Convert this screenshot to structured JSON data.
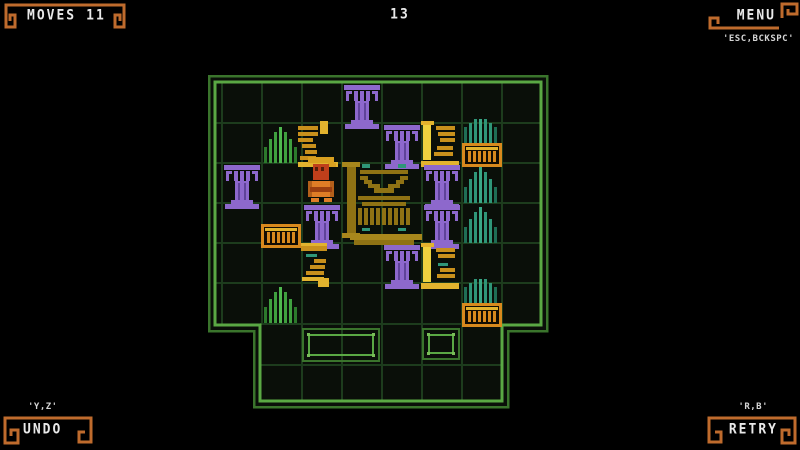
{
  "hud": {
    "moves_label": "MOVES",
    "moves_value": "11",
    "level_number": "13",
    "menu_label": "MENU",
    "menu_hint": "'ESC,BCKSPC'",
    "undo_label": "UNDO",
    "undo_hint": "'Y,Z'",
    "retry_label": "RETRY",
    "retry_hint": "'R,B'"
  },
  "palette": {
    "background": "#000000",
    "board_fill": "#0a0f09",
    "grid_line": "#1d3c1d",
    "border_outer": "#3a742c",
    "border_inner": "#5aa844",
    "goal_dot": "#79bd58",
    "hud_orange": "#bf6b2d",
    "text_white": "#e9e9e9",
    "purple": "#8d68cc",
    "purple_dark": "#5f4399",
    "gold": "#c8901c",
    "gold_bright": "#e2b32e",
    "yellow": "#edd23f",
    "teal": "#2f9678",
    "teal_dark": "#1f6e55",
    "teal_bright": "#3aa886",
    "green": "#3fa03f",
    "green_dark": "#2c7a2c",
    "green_bright": "#4fb84f",
    "crate": "#d8891d",
    "crate_dark": "#7a4c0e",
    "ink": "#120c02",
    "statue": "#8f7214",
    "statue_bright": "#a8871c",
    "player_body": "#df7d26",
    "player_arm": "#b35f1a",
    "player_belt": "#9c3f10",
    "player_head": "#bf3f1b",
    "player_eye": "#551d0a",
    "player_hat": "#d8a020"
  },
  "board": {
    "cols": 8,
    "rows": 6,
    "cell_px": 40,
    "origin_x": 222,
    "origin_y": 83,
    "objects": [
      {
        "type": "pillar-purple",
        "col": 3,
        "row": 0
      },
      {
        "type": "plant-green",
        "col": 1,
        "row": 1
      },
      {
        "type": "broken-column-left",
        "col": 2,
        "row": 1
      },
      {
        "type": "pillar-purple",
        "col": 4,
        "row": 1
      },
      {
        "type": "broken-column-right",
        "col": 5,
        "row": 1
      },
      {
        "type": "crate-plant",
        "col": 6,
        "row": 1
      },
      {
        "type": "pillar-purple",
        "col": 0,
        "row": 2
      },
      {
        "type": "player",
        "col": 2,
        "row": 2
      },
      {
        "type": "statue",
        "col": 3,
        "row": 2,
        "span_cols": 2,
        "span_rows": 2
      },
      {
        "type": "pillar-purple",
        "col": 5,
        "row": 2
      },
      {
        "type": "plant-teal",
        "col": 6,
        "row": 2
      },
      {
        "type": "crate",
        "col": 1,
        "row": 3
      },
      {
        "type": "pillar-purple",
        "col": 2,
        "row": 3
      },
      {
        "type": "pillar-purple",
        "col": 5,
        "row": 3
      },
      {
        "type": "plant-teal",
        "col": 6,
        "row": 3
      },
      {
        "type": "stairs-down",
        "col": 2,
        "row": 4
      },
      {
        "type": "pillar-purple",
        "col": 4,
        "row": 4
      },
      {
        "type": "broken-column-right-teal",
        "col": 5,
        "row": 4
      },
      {
        "type": "plant-green",
        "col": 1,
        "row": 5
      },
      {
        "type": "crate-plant",
        "col": 6,
        "row": 5
      }
    ],
    "goal_zones": [
      {
        "col": 2,
        "row": 6,
        "cols": 2
      },
      {
        "col": 5,
        "row": 6,
        "cols": 1
      }
    ]
  }
}
